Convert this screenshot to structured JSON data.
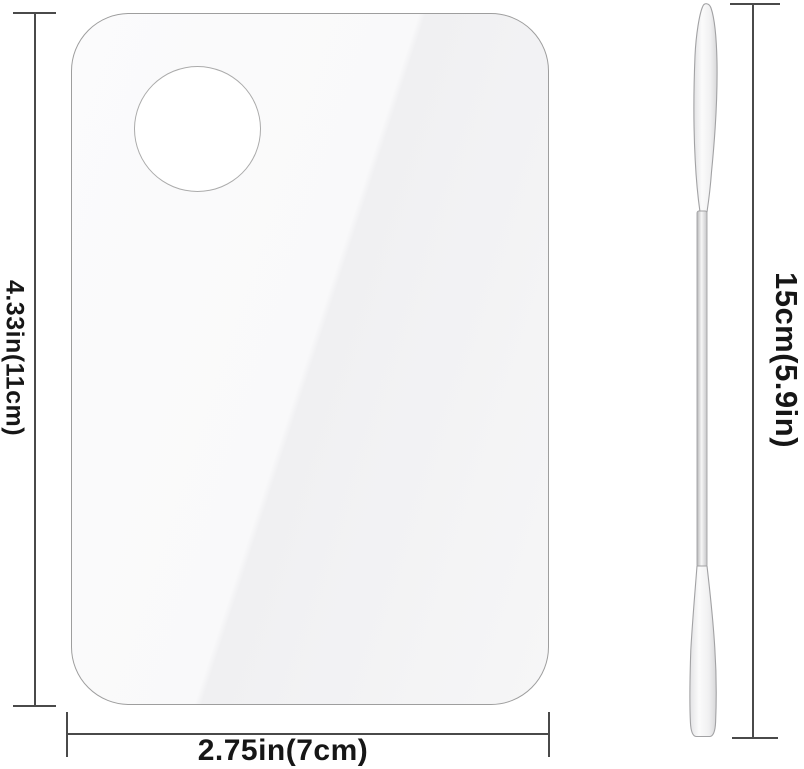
{
  "dimensions": {
    "palette_height": "4.33in(11cm)",
    "palette_width": "2.75in(7cm)",
    "spatula_length": "15cm(5.9in)"
  },
  "colors": {
    "background": "#ffffff",
    "dimension_line": "#4a4a4a",
    "label_text": "#161616",
    "palette_fill": "#f5f5f6",
    "palette_border": "#9e9e9e",
    "hole_border": "#ababab",
    "spatula_outline": "#a2a2a4"
  }
}
